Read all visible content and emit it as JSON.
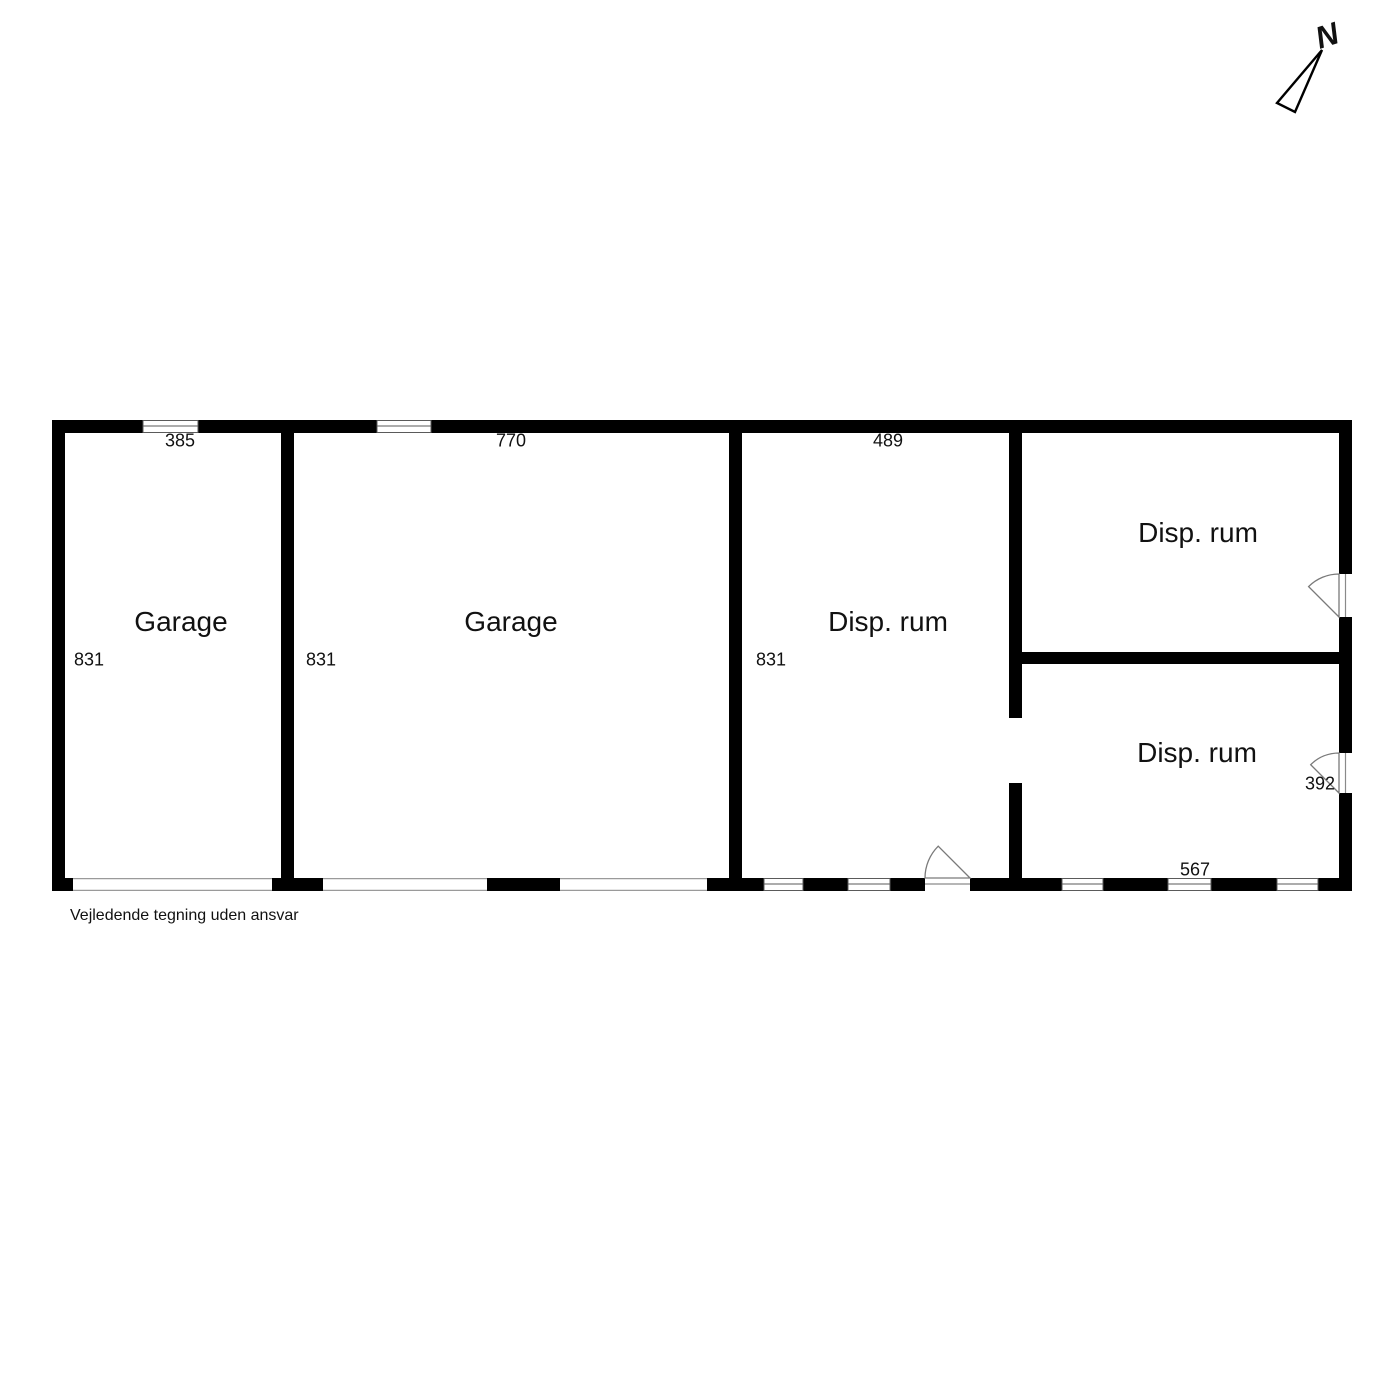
{
  "plan": {
    "type": "floor-plan",
    "rooms": [
      {
        "id": "garage-1",
        "label": "Garage",
        "top_dim": "385",
        "side_dim": "831"
      },
      {
        "id": "garage-2",
        "label": "Garage",
        "top_dim": "770",
        "side_dim": "831"
      },
      {
        "id": "disp-rum-1",
        "label": "Disp. rum",
        "top_dim": "489",
        "side_dim": "831"
      },
      {
        "id": "disp-rum-2",
        "label": "Disp. rum"
      },
      {
        "id": "disp-rum-3",
        "label": "Disp. rum",
        "door_dim": "392",
        "bottom_dim": "567"
      }
    ],
    "compass": {
      "label": "N"
    },
    "disclaimer": "Vejledende tegning uden ansvar",
    "colors": {
      "wall": "#000000",
      "background": "#ffffff",
      "door_line": "#7a7a7a",
      "window_line": "#5a5a5a",
      "text": "#111111"
    }
  }
}
